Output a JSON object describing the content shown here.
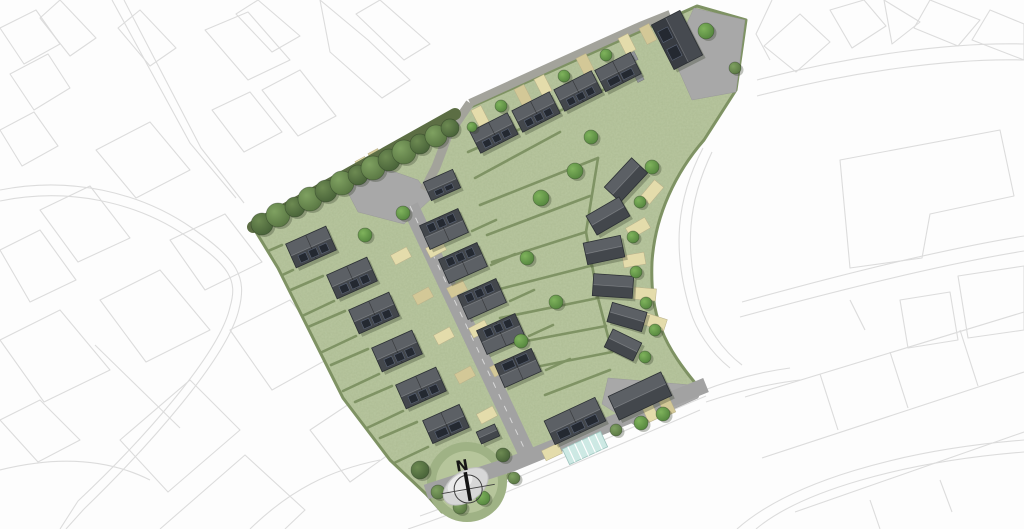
{
  "meta": {
    "description": "Aerial masterplan of a housing development site with landscaped green, spine road, solar-panelled roofs, tree planting and north arrow, surrounded by faint grey OS-style context line work",
    "north_label": "N"
  },
  "palette": {
    "background": "#fdfdfd",
    "context_line": "#dcdcdc",
    "grass": "#b9c7a0",
    "grass_dark": "#9fb285",
    "grass_mid": "#b6c59b",
    "hedge": "#7f9364",
    "tree_band": "#5c6e44",
    "road": "#a2a2a2",
    "road_lane": "#a3a39b",
    "court": "#a8a8a8",
    "roof_light": "#5c6065",
    "roof_dark": "#43474c",
    "roof_big": "#464a50",
    "panel": "#242931",
    "parking_light": "#e4dcab",
    "parking_dark": "#d3c897",
    "glazing": "#cde9e4",
    "compass_blob": "#d7d7d7",
    "compass_ink": "#161616",
    "bin_store": "#90949a",
    "shadow": "rgba(45,55,35,0.30)"
  },
  "site": {
    "outline": "M 253 227 L 455 114 L 697 6 L 746 20 L 736 90 L 704 140 C 676 172 655 215 652 262 C 650 315 662 345 702 391 L 600 434 L 512 468 L 500 490 L 472 516 L 442 512 L 426 494 L 390 460 L 343 398 L 278 268 Z",
    "tree_band": [
      [
        253,
        227
      ],
      [
        455,
        114
      ]
    ]
  },
  "roads": {
    "bottom_street": {
      "pts": [
        [
          426,
          492
        ],
        [
          512,
          464
        ],
        [
          600,
          428
        ],
        [
          706,
          385
        ]
      ],
      "w": 15
    },
    "spine": {
      "pts": [
        [
          410,
          206
        ],
        [
          526,
          452
        ]
      ],
      "w": 17
    },
    "lane": {
      "pts": [
        [
          470,
          103
        ],
        [
          560,
          62
        ],
        [
          640,
          26
        ],
        [
          670,
          14
        ]
      ],
      "w": 8
    },
    "connector": {
      "pts": [
        [
          470,
          103
        ],
        [
          448,
          135
        ],
        [
          436,
          167
        ],
        [
          424,
          190
        ]
      ],
      "w": 9
    },
    "head_poly": [
      [
        344,
        185
      ],
      [
        372,
        164
      ],
      [
        418,
        180
      ],
      [
        432,
        198
      ],
      [
        404,
        224
      ],
      [
        358,
        212
      ]
    ],
    "court_tr": [
      [
        672,
        55
      ],
      [
        694,
        8
      ],
      [
        745,
        20
      ],
      [
        736,
        92
      ],
      [
        692,
        100
      ]
    ],
    "court_br": [
      [
        608,
        378
      ],
      [
        703,
        386
      ],
      [
        698,
        398
      ],
      [
        636,
        426
      ],
      [
        602,
        404
      ]
    ]
  },
  "houses": [
    {
      "x": 311,
      "y": 247,
      "l": 44,
      "w": 26,
      "rot": -24,
      "dark": "pos",
      "panels": 3,
      "split": true
    },
    {
      "x": 352,
      "y": 278,
      "l": 44,
      "w": 26,
      "rot": -24,
      "dark": "pos",
      "panels": 3,
      "split": true
    },
    {
      "x": 374,
      "y": 313,
      "l": 44,
      "w": 26,
      "rot": -24,
      "dark": "pos",
      "panels": 3,
      "split": true
    },
    {
      "x": 397,
      "y": 351,
      "l": 44,
      "w": 26,
      "rot": -24,
      "dark": "pos",
      "panels": 3,
      "split": true
    },
    {
      "x": 421,
      "y": 388,
      "l": 44,
      "w": 26,
      "rot": -24,
      "dark": "pos",
      "panels": 3,
      "split": true
    },
    {
      "x": 446,
      "y": 424,
      "l": 40,
      "w": 25,
      "rot": -24,
      "dark": "pos",
      "panels": 2,
      "split": true
    },
    {
      "x": 442,
      "y": 185,
      "l": 32,
      "w": 20,
      "rot": -24,
      "dark": "pos",
      "panels": 2,
      "split": false
    },
    {
      "x": 444,
      "y": 229,
      "l": 42,
      "w": 26,
      "rot": -24,
      "dark": "neg",
      "panels": 3,
      "split": true
    },
    {
      "x": 463,
      "y": 263,
      "l": 42,
      "w": 26,
      "rot": -24,
      "dark": "neg",
      "panels": 3,
      "split": true
    },
    {
      "x": 482,
      "y": 299,
      "l": 42,
      "w": 26,
      "rot": -24,
      "dark": "neg",
      "panels": 3,
      "split": true
    },
    {
      "x": 501,
      "y": 334,
      "l": 42,
      "w": 26,
      "rot": -24,
      "dark": "neg",
      "panels": 3,
      "split": true
    },
    {
      "x": 518,
      "y": 368,
      "l": 40,
      "w": 25,
      "rot": -24,
      "dark": "neg",
      "panels": 2,
      "split": true
    },
    {
      "x": 494,
      "y": 133,
      "l": 42,
      "w": 24,
      "rot": -27,
      "dark": "pos",
      "panels": 3,
      "split": true
    },
    {
      "x": 536,
      "y": 112,
      "l": 42,
      "w": 24,
      "rot": -27,
      "dark": "pos",
      "panels": 3,
      "split": true
    },
    {
      "x": 578,
      "y": 91,
      "l": 42,
      "w": 24,
      "rot": -27,
      "dark": "pos",
      "panels": 3,
      "split": true
    },
    {
      "x": 618,
      "y": 72,
      "l": 40,
      "w": 24,
      "rot": -27,
      "dark": "pos",
      "panels": 2,
      "split": true
    },
    {
      "x": 677,
      "y": 40,
      "l": 50,
      "w": 32,
      "rot": 63,
      "dark": "pos",
      "panels": 2,
      "split": false,
      "big": true
    },
    {
      "x": 626,
      "y": 180,
      "l": 40,
      "w": 22,
      "rot": -47,
      "dark": "pos",
      "panels": 0,
      "split": false
    },
    {
      "x": 608,
      "y": 216,
      "l": 38,
      "w": 22,
      "rot": -30,
      "dark": "pos",
      "panels": 0,
      "split": false
    },
    {
      "x": 604,
      "y": 250,
      "l": 38,
      "w": 22,
      "rot": -12,
      "dark": "pos",
      "panels": 0,
      "split": false
    },
    {
      "x": 613,
      "y": 286,
      "l": 40,
      "w": 22,
      "rot": 4,
      "dark": "pos",
      "panels": 0,
      "split": false
    },
    {
      "x": 627,
      "y": 317,
      "l": 36,
      "w": 20,
      "rot": 16,
      "dark": "pos",
      "panels": 0,
      "split": false
    },
    {
      "x": 623,
      "y": 345,
      "l": 32,
      "w": 20,
      "rot": 26,
      "dark": "pos",
      "panels": 0,
      "split": false
    },
    {
      "x": 640,
      "y": 396,
      "l": 58,
      "w": 26,
      "rot": -25,
      "dark": "pos",
      "panels": 0,
      "split": false
    },
    {
      "x": 575,
      "y": 421,
      "l": 56,
      "w": 26,
      "rot": -25,
      "dark": "pos",
      "panels": 3,
      "split": true
    },
    {
      "x": 488,
      "y": 434,
      "l": 20,
      "w": 13,
      "rot": -24,
      "dark": "pos",
      "panels": 0,
      "split": false
    }
  ],
  "parking": [
    {
      "x": 436,
      "y": 249,
      "rot": -28
    },
    {
      "x": 457,
      "y": 289,
      "rot": -28
    },
    {
      "x": 479,
      "y": 329,
      "rot": -28
    },
    {
      "x": 500,
      "y": 368,
      "rot": -28
    },
    {
      "x": 401,
      "y": 256,
      "rot": -28
    },
    {
      "x": 423,
      "y": 296,
      "rot": -28
    },
    {
      "x": 444,
      "y": 336,
      "rot": -28
    },
    {
      "x": 465,
      "y": 375,
      "rot": -28
    },
    {
      "x": 487,
      "y": 415,
      "rot": -28
    },
    {
      "x": 352,
      "y": 176,
      "rot": 62
    },
    {
      "x": 364,
      "y": 167,
      "rot": 62
    },
    {
      "x": 377,
      "y": 159,
      "rot": 62
    },
    {
      "x": 480,
      "y": 116,
      "rot": 63
    },
    {
      "x": 523,
      "y": 95,
      "rot": 63
    },
    {
      "x": 543,
      "y": 85,
      "rot": 63
    },
    {
      "x": 585,
      "y": 64,
      "rot": 63
    },
    {
      "x": 627,
      "y": 44,
      "rot": 63
    },
    {
      "x": 648,
      "y": 34,
      "rot": 63
    },
    {
      "x": 650,
      "y": 412,
      "rot": 65
    },
    {
      "x": 667,
      "y": 406,
      "rot": 65
    },
    {
      "x": 552,
      "y": 452,
      "rot": -25
    }
  ],
  "drives": [
    {
      "x": 652,
      "y": 192,
      "rot": -50
    },
    {
      "x": 638,
      "y": 228,
      "rot": -30
    },
    {
      "x": 634,
      "y": 260,
      "rot": -10
    },
    {
      "x": 645,
      "y": 294,
      "rot": 5
    },
    {
      "x": 655,
      "y": 322,
      "rot": 18
    }
  ],
  "hedges": [
    [
      293,
      270,
      257,
      287
    ],
    [
      334,
      301,
      298,
      318
    ],
    [
      356,
      336,
      320,
      353
    ],
    [
      379,
      374,
      343,
      391
    ],
    [
      403,
      411,
      367,
      428
    ],
    [
      428,
      447,
      392,
      464
    ],
    [
      282,
      245,
      245,
      261
    ],
    [
      323,
      276,
      286,
      292
    ],
    [
      345,
      311,
      308,
      327
    ],
    [
      368,
      349,
      331,
      365
    ],
    [
      392,
      386,
      355,
      402
    ],
    [
      417,
      422,
      380,
      438
    ],
    [
      472,
      231,
      496,
      220
    ],
    [
      491,
      265,
      515,
      254
    ],
    [
      510,
      301,
      534,
      290
    ],
    [
      529,
      336,
      553,
      325
    ],
    [
      546,
      370,
      570,
      359
    ],
    [
      480,
      205,
      598,
      158
    ],
    [
      487,
      235,
      590,
      196
    ],
    [
      492,
      262,
      586,
      232
    ],
    [
      496,
      290,
      590,
      266
    ],
    [
      500,
      318,
      598,
      298
    ],
    [
      505,
      345,
      606,
      326
    ],
    [
      510,
      372,
      612,
      352
    ],
    [
      475,
      178,
      560,
      132
    ],
    [
      598,
      158,
      586,
      232
    ],
    [
      586,
      232,
      598,
      298
    ],
    [
      598,
      298,
      612,
      352
    ],
    [
      468,
      152,
      545,
      118
    ],
    [
      545,
      118,
      640,
      72
    ],
    [
      545,
      395,
      610,
      370
    ]
  ],
  "trees": [
    {
      "x": 262,
      "y": 224,
      "r": 11,
      "k": "d"
    },
    {
      "x": 278,
      "y": 215,
      "r": 12,
      "k": "m"
    },
    {
      "x": 295,
      "y": 207,
      "r": 10,
      "k": "d"
    },
    {
      "x": 310,
      "y": 199,
      "r": 12,
      "k": "m"
    },
    {
      "x": 326,
      "y": 191,
      "r": 11,
      "k": "d"
    },
    {
      "x": 342,
      "y": 183,
      "r": 12,
      "k": "m"
    },
    {
      "x": 358,
      "y": 175,
      "r": 10,
      "k": "d"
    },
    {
      "x": 373,
      "y": 168,
      "r": 12,
      "k": "m"
    },
    {
      "x": 389,
      "y": 160,
      "r": 11,
      "k": "d"
    },
    {
      "x": 404,
      "y": 152,
      "r": 12,
      "k": "m"
    },
    {
      "x": 420,
      "y": 144,
      "r": 10,
      "k": "d"
    },
    {
      "x": 436,
      "y": 136,
      "r": 11,
      "k": "m"
    },
    {
      "x": 450,
      "y": 128,
      "r": 9,
      "k": "d"
    },
    {
      "x": 420,
      "y": 470,
      "r": 9,
      "k": "d"
    },
    {
      "x": 438,
      "y": 492,
      "r": 7,
      "k": "m"
    },
    {
      "x": 460,
      "y": 507,
      "r": 7,
      "k": "m"
    },
    {
      "x": 483,
      "y": 498,
      "r": 7,
      "k": "b"
    },
    {
      "x": 503,
      "y": 455,
      "r": 7,
      "k": "d"
    },
    {
      "x": 514,
      "y": 478,
      "r": 6,
      "k": "m"
    },
    {
      "x": 541,
      "y": 198,
      "r": 8,
      "k": "b"
    },
    {
      "x": 575,
      "y": 171,
      "r": 8,
      "k": "b"
    },
    {
      "x": 591,
      "y": 137,
      "r": 7,
      "k": "b"
    },
    {
      "x": 527,
      "y": 258,
      "r": 7,
      "k": "b"
    },
    {
      "x": 556,
      "y": 302,
      "r": 7,
      "k": "b"
    },
    {
      "x": 521,
      "y": 341,
      "r": 7,
      "k": "b"
    },
    {
      "x": 652,
      "y": 167,
      "r": 7,
      "k": "b"
    },
    {
      "x": 640,
      "y": 202,
      "r": 6,
      "k": "b"
    },
    {
      "x": 633,
      "y": 237,
      "r": 6,
      "k": "b"
    },
    {
      "x": 636,
      "y": 272,
      "r": 6,
      "k": "b"
    },
    {
      "x": 646,
      "y": 303,
      "r": 6,
      "k": "b"
    },
    {
      "x": 655,
      "y": 330,
      "r": 6,
      "k": "b"
    },
    {
      "x": 645,
      "y": 357,
      "r": 6,
      "k": "b"
    },
    {
      "x": 365,
      "y": 235,
      "r": 7,
      "k": "b"
    },
    {
      "x": 403,
      "y": 213,
      "r": 7,
      "k": "b"
    },
    {
      "x": 501,
      "y": 106,
      "r": 6,
      "k": "b"
    },
    {
      "x": 564,
      "y": 76,
      "r": 6,
      "k": "b"
    },
    {
      "x": 606,
      "y": 55,
      "r": 6,
      "k": "b"
    },
    {
      "x": 472,
      "y": 127,
      "r": 5,
      "k": "b"
    },
    {
      "x": 706,
      "y": 31,
      "r": 8,
      "k": "b"
    },
    {
      "x": 735,
      "y": 68,
      "r": 6,
      "k": "m"
    },
    {
      "x": 641,
      "y": 423,
      "r": 7,
      "k": "b"
    },
    {
      "x": 663,
      "y": 414,
      "r": 7,
      "k": "b"
    },
    {
      "x": 616,
      "y": 430,
      "r": 6,
      "k": "m"
    }
  ],
  "glazing": {
    "x": 585,
    "y": 448,
    "l": 42,
    "w": 17,
    "rot": -25
  },
  "bins": [
    {
      "x": 633,
      "y": 57,
      "rot": 63
    },
    {
      "x": 639,
      "y": 77,
      "rot": 63
    }
  ],
  "mound": {
    "x": 467,
    "y": 482,
    "r_outer": 40,
    "r_inner": 31
  },
  "compass": {
    "x": 468,
    "y": 488,
    "label": "N",
    "rot": -10
  },
  "context_paths": [
    "M112 0 L190 143 L236 198",
    "M124 0 L201 148 L244 203",
    "M0 190 C70 176 140 192 192 228 C238 260 247 277 239 309 C228 357 150 445 84 509 L66 529",
    "M0 201 C68 187 136 202 186 236 C230 266 238 280 230 307 C220 353 144 439 78 501 L60 529",
    "M0 28 L36 10 L60 44 L24 64 Z",
    "M10 74 L48 54 L70 88 L34 110 Z",
    "M0 130 L34 112 L58 146 L22 166 Z",
    "M60 0 L96 38 L70 56 L40 18 Z",
    "M140 10 L176 48 L150 66 L118 28 Z",
    "M205 30 L248 12 L290 60 L248 80 Z",
    "M262 90 L300 70 L336 116 L298 136 Z",
    "M212 110 L250 92 L282 132 L244 152 Z",
    "M258 0 L300 36 L272 52 L236 14 Z",
    "M320 0 L368 40 L410 80 L382 98 L330 52 Z",
    "M380 0 L430 44 L404 60 L356 14 Z",
    "M96 150 L150 122 L190 170 L136 198 Z",
    "M40 210 L90 186 L130 238 L78 262 Z",
    "M0 250 L40 230 L76 280 L30 302 Z",
    "M0 340 L60 310 L110 370 L44 402 Z",
    "M100 300 L160 270 L210 330 L146 362 Z",
    "M170 240 L225 214 L262 262 L205 290 Z",
    "M120 440 L190 380 L240 430 L168 492 Z",
    "M230 330 L290 300 L335 355 L272 390 Z",
    "M95 345 L180 428",
    "M160 529 L245 455 L305 510 L285 529",
    "M310 430 L355 400 L395 450 L350 482 Z",
    "M250 529 C290 490 330 470 380 460",
    "M0 420 L40 400 L80 440 L38 462 Z",
    "M0 470 C60 455 110 460 150 480",
    "M757 80 C850 56 950 42 1024 44",
    "M757 96 C850 72 950 58 1024 60",
    "M772 0 L756 34 L770 60",
    "M764 46 L800 14 L830 42 L796 72 Z",
    "M830 10 L864 0 L886 26 L852 48 Z",
    "M884 0 L920 22 L892 44 Z",
    "M930 0 L980 20 L958 46 L914 28 Z",
    "M990 10 L1024 24 L1024 60 L972 40 Z",
    "M840 160 L1000 130 L1014 196 L930 214 L922 258 L850 268 Z",
    "M958 276 L1024 266 L1024 330 L968 338 Z",
    "M900 300 L950 292 L958 340 L908 348 Z",
    "M742 302 C850 272 950 248 1024 236",
    "M740 317 C850 287 950 263 1024 251",
    "M745 397 L1024 312",
    "M762 458 L1024 372",
    "M795 512 L1024 432",
    "M756 529 C800 492 900 462 1024 452",
    "M737 529 C790 482 900 450 1024 440",
    "M820 374 L838 430",
    "M890 352 L908 408",
    "M960 330 L978 386",
    "M850 300 L865 330",
    "M940 480 L952 512",
    "M870 500 L880 529",
    "M703 148 C676 200 672 250 690 310 C696 330 710 352 730 368",
    "M712 152 C688 202 684 248 700 305 C707 327 722 350 742 365",
    "M420 516 C500 488 600 440 706 396",
    "M408 529 C480 505 580 462 700 410",
    "M702 391 C730 380 760 372 790 368",
    "M706 402 C736 392 766 384 800 380"
  ]
}
